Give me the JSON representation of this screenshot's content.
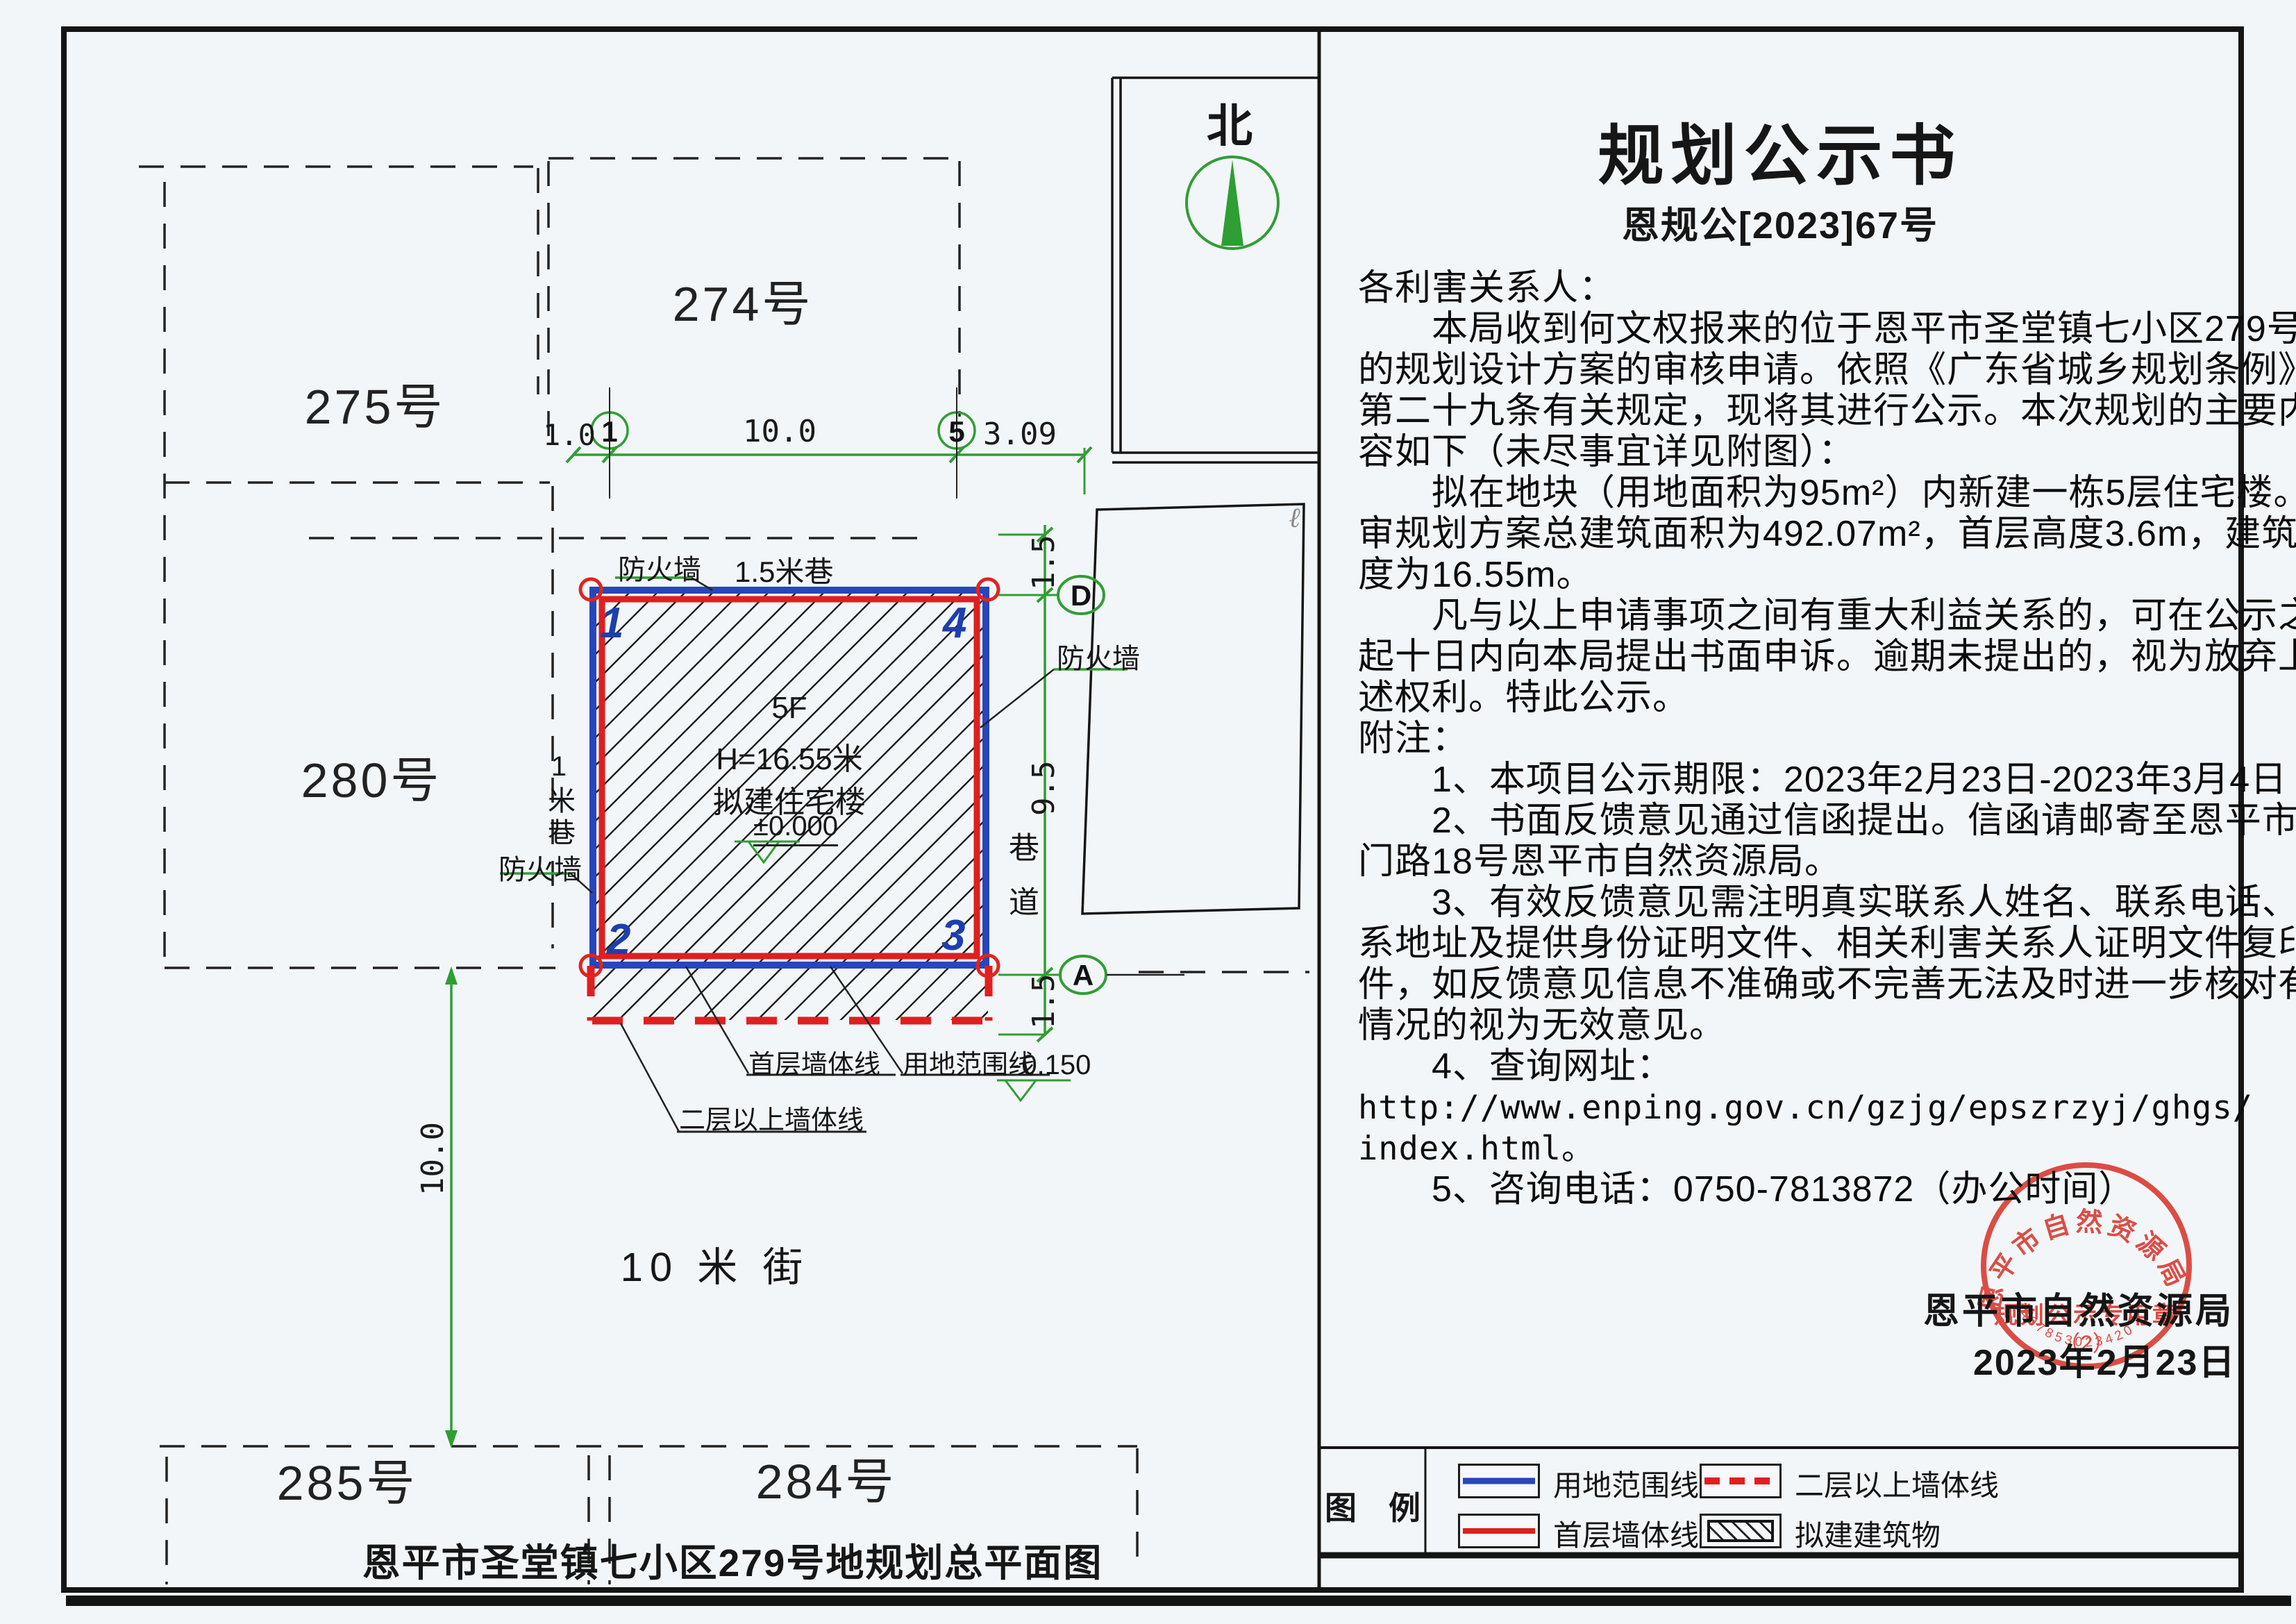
{
  "announcement": {
    "title": "规划公示书",
    "doc_no": "恩规公[2023]67号",
    "lines": [
      "各利害关系人：",
      "本局收到何文权报来的位于恩平市圣堂镇七小区279号地",
      "的规划设计方案的审核申请。依照《广东省城乡规划条例》",
      "第二十九条有关规定，现将其进行公示。本次规划的主要内",
      "容如下（未尽事宜详见附图）：",
      "拟在地块（用地面积为95m²）内新建一栋5层住宅楼。送",
      "审规划方案总建筑面积为492.07m²，首层高度3.6m，建筑总高",
      "度为16.55m。",
      "凡与以上申请事项之间有重大利益关系的，可在公示之日",
      "起十日内向本局提出书面申诉。逾期未提出的，视为放弃上",
      "述权利。特此公示。",
      "附注：",
      "1、本项目公示期限：2023年2月23日-2023年3月4日",
      "2、书面反馈意见通过信函提出。信函请邮寄至恩平市西",
      "门路18号恩平市自然资源局。",
      "3、有效反馈意见需注明真实联系人姓名、联系电话、联",
      "系地址及提供身份证明文件、相关利害关系人证明文件复印",
      "件，如反馈意见信息不准确或不完善无法及时进一步核对有关",
      "情况的视为无效意见。",
      "4、查询网址：",
      "http://www.enping.gov.cn/gzjg/epszrzyj/ghgs/",
      "index.html。",
      "5、咨询电话：0750-7813872（办公时间）"
    ],
    "agency": "恩平市自然资源局",
    "date": "2023年2月23日"
  },
  "stamp": {
    "ring_text": "恩平市自然资源局",
    "inner_text": "规划公示专用章",
    "sub_text": "（2）",
    "serial": "4407853023420"
  },
  "plan": {
    "north": "北",
    "title": "恩平市圣堂镇七小区279号地规划总平面图",
    "street": "10 米 街",
    "plots": {
      "p275": "275号",
      "p274": "274号",
      "p280": "280号",
      "p285": "285号",
      "p284": "284号"
    },
    "building": {
      "floors": "5F",
      "height": "H=16.55米",
      "name": "拟建住宅楼",
      "level_zero": "±0.000",
      "level_low": "-0.150",
      "corner_tl": "1",
      "corner_tr": "4",
      "corner_bl": "2",
      "corner_br": "3"
    },
    "labels": {
      "firewall_top": "防火墙",
      "firewall_left": "防火墙",
      "firewall_right": "防火墙",
      "lane15": "1.5米巷",
      "lane1": "1米巷",
      "alley": "巷道",
      "first_wall": "首层墙体线",
      "site_line": "用地范围线",
      "upper_wall": "二层以上墙体线",
      "artifact": "ℓ"
    },
    "dims": {
      "h_left": "1.0",
      "h_mid": "10.0",
      "h_right": "3.09",
      "v_top": "1.5",
      "v_mid": "9.5",
      "v_bot": "1.5",
      "street_w": "10.0"
    },
    "axes": {
      "a1": "1",
      "a5": "5",
      "aD": "D",
      "aA": "A"
    }
  },
  "legend": {
    "header": "图　例",
    "items": [
      {
        "label": "用地范围线",
        "type": "blue-solid"
      },
      {
        "label": "二层以上墙体线",
        "type": "red-dashed"
      },
      {
        "label": "首层墙体线",
        "type": "red-solid"
      },
      {
        "label": "拟建建筑物",
        "type": "hatch"
      }
    ]
  },
  "colors": {
    "dim_green": "#2f9e33",
    "site_blue": "#2746bb",
    "wall_red": "#df1f1f",
    "stamp_red": "#d8352a"
  }
}
